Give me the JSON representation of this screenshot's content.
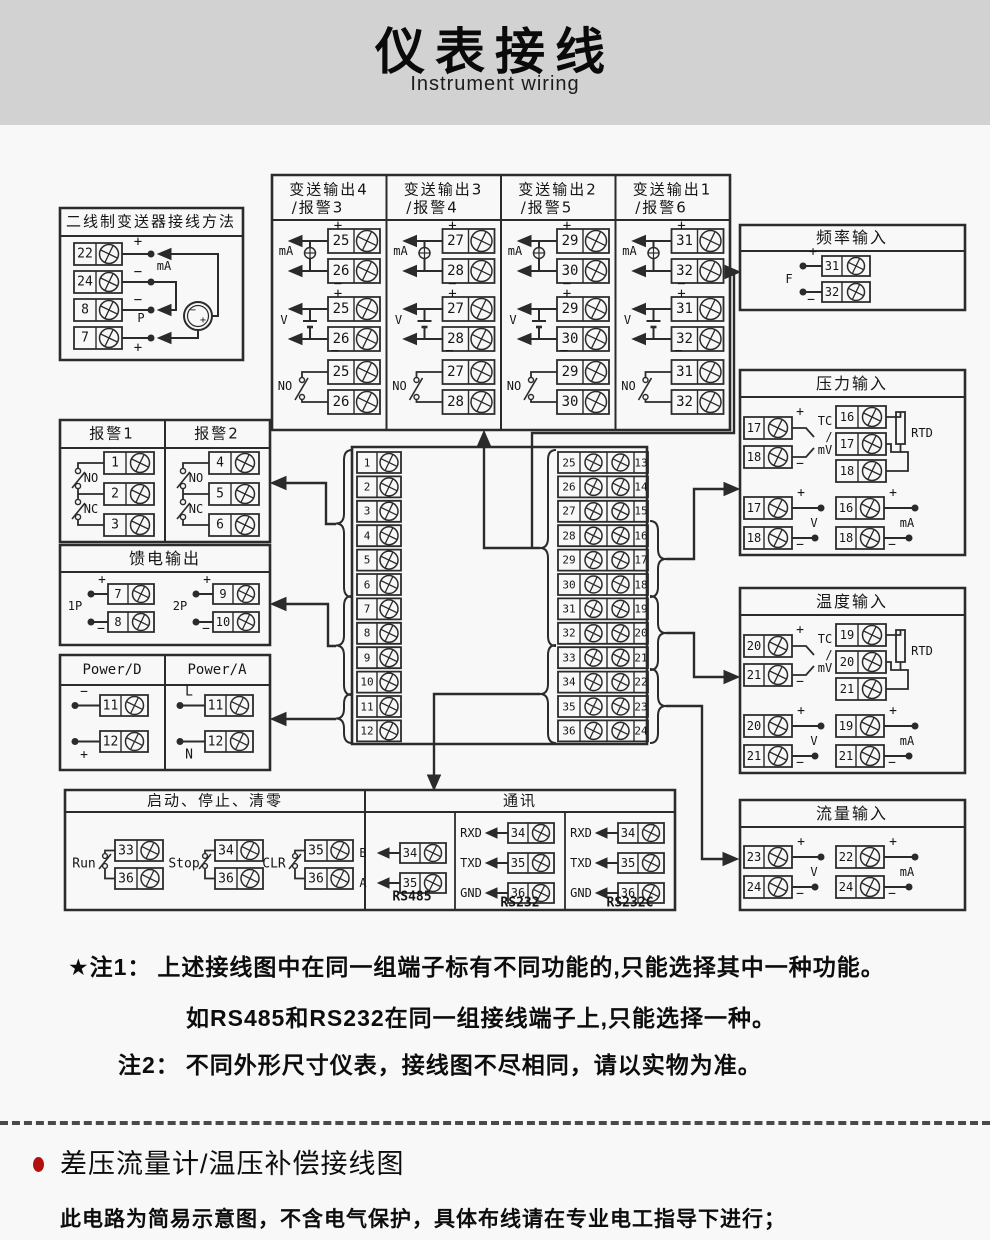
{
  "header": {
    "title": "仪表接线",
    "subtitle": "Instrument wiring"
  },
  "sym": {
    "plus": "+",
    "minus": "−",
    "p": "P",
    "f": "F",
    "tc": "TC",
    "slash": "/",
    "mv": "mV",
    "rtd": "RTD",
    "v": "V",
    "ma": "mA",
    "no": "NO",
    "nc": "NC"
  },
  "two_wire": {
    "title": "二线制变送器接线方法",
    "terms": [
      "22",
      "24",
      "8",
      "7"
    ]
  },
  "transmit": {
    "columns": [
      {
        "line1": "变送输出4",
        "line2": "/报警3",
        "terms": [
          "25",
          "26"
        ]
      },
      {
        "line1": "变送输出3",
        "line2": "/报警4",
        "terms": [
          "27",
          "28"
        ]
      },
      {
        "line1": "变送输出2",
        "line2": "/报警5",
        "terms": [
          "29",
          "30"
        ]
      },
      {
        "line1": "变送输出1",
        "line2": "/报警6",
        "terms": [
          "31",
          "32"
        ]
      }
    ]
  },
  "freq": {
    "title": "频率输入",
    "terms": [
      "31",
      "32"
    ]
  },
  "pressure": {
    "title": "压力输入",
    "tc_terms": [
      "17",
      "18"
    ],
    "rtd_terms": [
      "16",
      "17",
      "18"
    ],
    "v_terms": [
      "17",
      "18"
    ],
    "ma_terms": [
      "16",
      "18"
    ]
  },
  "temp": {
    "title": "温度输入",
    "tc_terms": [
      "20",
      "21"
    ],
    "rtd_terms": [
      "19",
      "20",
      "21"
    ],
    "v_terms": [
      "20",
      "21"
    ],
    "ma_terms": [
      "19",
      "21"
    ]
  },
  "flow": {
    "title": "流量输入",
    "v_terms": [
      "23",
      "24"
    ],
    "ma_terms": [
      "22",
      "24"
    ]
  },
  "alarm": {
    "cols": [
      {
        "title": "报警1",
        "terms": [
          "1",
          "2",
          "3"
        ]
      },
      {
        "title": "报警2",
        "terms": [
          "4",
          "5",
          "6"
        ]
      }
    ]
  },
  "feed": {
    "title": "馈电输出",
    "groups": [
      {
        "label": "1P",
        "terms": [
          "7",
          "8"
        ]
      },
      {
        "label": "2P",
        "terms": [
          "9",
          "10"
        ]
      }
    ]
  },
  "power": {
    "cols": [
      {
        "title": "Power/D",
        "top_label": "−",
        "bottom_label": "+",
        "terms": [
          "11",
          "12"
        ]
      },
      {
        "title": "Power/A",
        "top_label": "L",
        "bottom_label": "N",
        "terms": [
          "11",
          "12"
        ]
      }
    ]
  },
  "center": {
    "left": [
      "1",
      "2",
      "3",
      "4",
      "5",
      "6",
      "7",
      "8",
      "9",
      "10",
      "11",
      "12"
    ],
    "right_left": [
      "25",
      "26",
      "27",
      "28",
      "29",
      "30",
      "31",
      "32",
      "33",
      "34",
      "35",
      "36"
    ],
    "right_right": [
      "13",
      "14",
      "15",
      "16",
      "17",
      "18",
      "19",
      "20",
      "21",
      "22",
      "23",
      "24"
    ]
  },
  "runstop": {
    "title": "启动、停止、清零",
    "groups": [
      {
        "label": "Run",
        "terms": [
          "33",
          "36"
        ]
      },
      {
        "label": "Stop",
        "terms": [
          "34",
          "36"
        ]
      },
      {
        "label": "CLR",
        "terms": [
          "35",
          "36"
        ]
      }
    ]
  },
  "comm": {
    "title": "通讯",
    "sections": [
      {
        "name": "RS485",
        "rows": [
          {
            "label": "B",
            "term": "34"
          },
          {
            "label": "A",
            "term": "35"
          }
        ]
      },
      {
        "name": "RS232",
        "rows": [
          {
            "label": "RXD",
            "term": "34"
          },
          {
            "label": "TXD",
            "term": "35"
          },
          {
            "label": "GND",
            "term": "36"
          }
        ]
      },
      {
        "name": "RS232C",
        "rows": [
          {
            "label": "RXD",
            "term": "34"
          },
          {
            "label": "TXD",
            "term": "35"
          },
          {
            "label": "GND",
            "term": "36"
          }
        ]
      }
    ]
  },
  "notes": {
    "n1_label": "★注1：",
    "n1_text": "上述接线图中在同一组端子标有不同功能的,只能选择其中一种功能。",
    "n1_text2": "如RS485和RS232在同一组接线端子上,只能选择一种。",
    "n2_label": "注2：",
    "n2_text": "不同外形尺寸仪表，接线图不尽相同，请以实物为准。"
  },
  "section2": {
    "heading": "差压流量计/温压补偿接线图",
    "para": "此电路为简易示意图，不含电气保护，具体布线请在专业电工指导下进行；"
  },
  "colors": {
    "accent_red": "#b40f0f",
    "stroke": "#2b2b2b",
    "header_bg": "#d2d2d2",
    "page_bg": "#f8f8f8"
  }
}
